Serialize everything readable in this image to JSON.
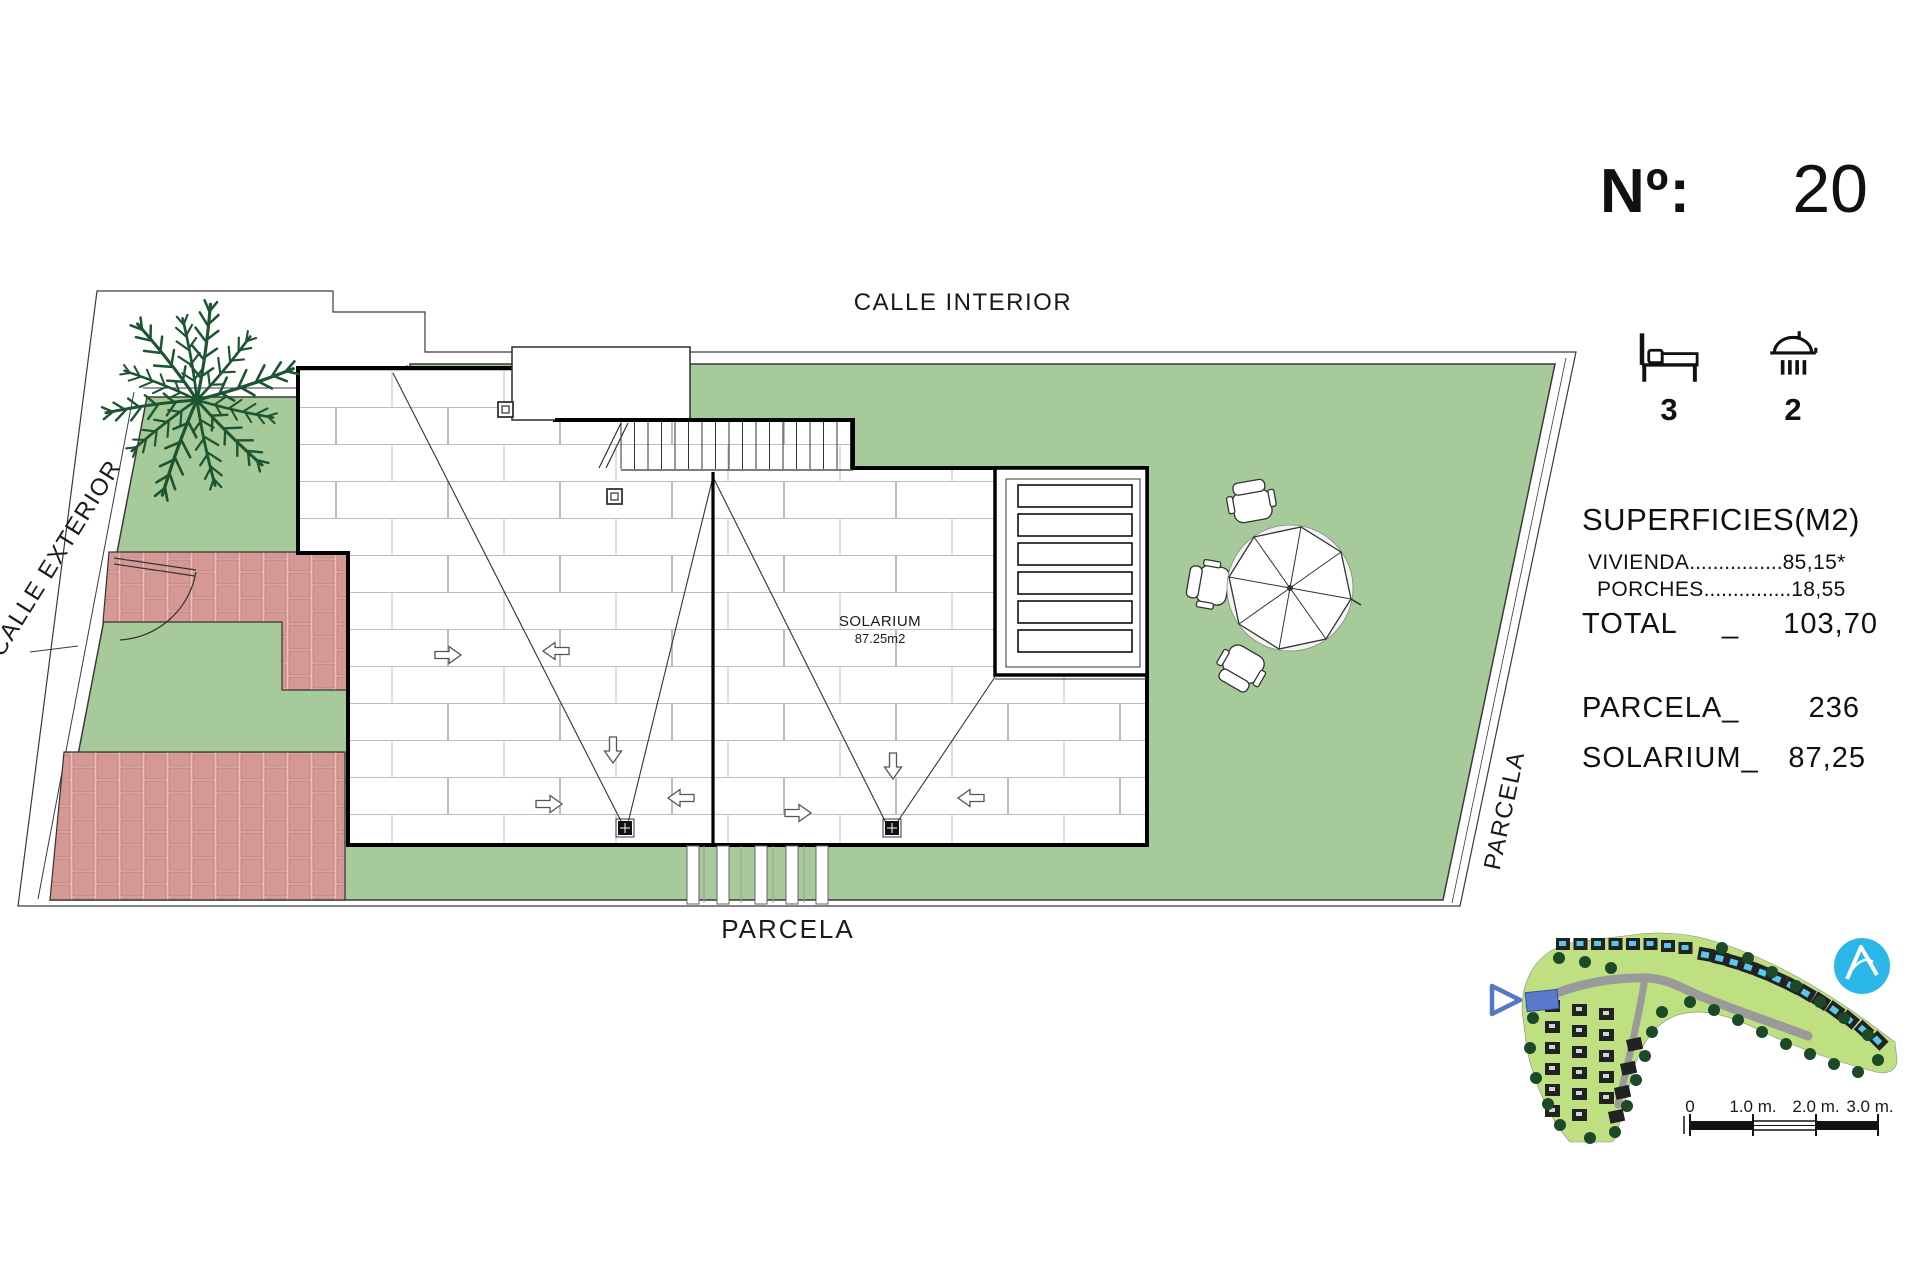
{
  "plan": {
    "street_top_label": "CALLE INTERIOR",
    "street_left_label": "CALLE EXTERIOR",
    "parcel_bottom_label": "PARCELA",
    "parcel_right_label": "PARCELA",
    "solarium_label": "SOLARIUM",
    "solarium_area": "87.25m2"
  },
  "panel": {
    "number_label": "Nº:",
    "number_value": "20",
    "bedrooms": "3",
    "bathrooms": "2",
    "surfaces_title": "SUPERFICIES(M2)",
    "vivienda_label": "VIVIENDA",
    "vivienda_leader": "................",
    "vivienda_value": "85,15*",
    "porches_label": "PORCHES",
    "porches_leader": "...............",
    "porches_value": "18,55",
    "total_label": "TOTAL",
    "total_sep": "_",
    "total_value": "103,70",
    "parcela_label": "PARCELA_",
    "parcela_value": "236",
    "solarium_label": "SOLARIUM_",
    "solarium_value": "87,25"
  },
  "scalebar": {
    "zero": "0",
    "one": "1.0 m.",
    "two": "2.0 m.",
    "three": "3.0 m."
  },
  "colors": {
    "grass": "#a6ca9a",
    "brick": "#d69894",
    "minimap_grass": "#bfe081",
    "logo_blue": "#2cb7e9",
    "highlight_blue": "#5b79cc"
  }
}
